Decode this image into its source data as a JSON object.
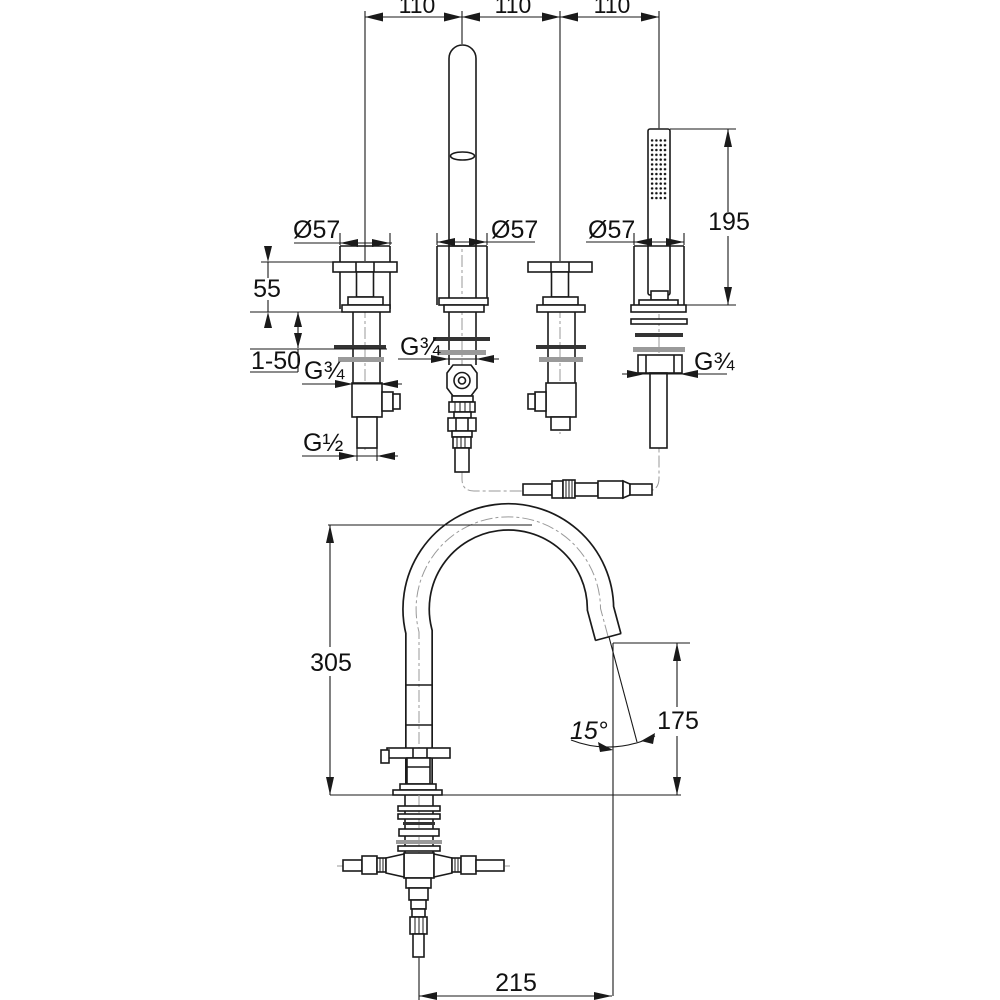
{
  "drawing": {
    "type": "technical-dimension-drawing",
    "subject": "4-hole deck-mounted bath mixer with gooseneck spout and hand shower",
    "colors": {
      "line": "#1a1a1a",
      "centerline": "#9a9a9a",
      "background": "#ffffff"
    },
    "dims": {
      "spacing_left": "110",
      "spacing_center": "110",
      "spacing_right": "110",
      "valve_diameter": "Ø57",
      "spout_diameter": "Ø57",
      "shower_diameter": "Ø57",
      "handle_height": "55",
      "deck_thickness_range": "1-50",
      "valve_thread": "G¾",
      "spout_thread": "G¾",
      "shower_thread": "G¾",
      "valve_outlet_thread": "G½",
      "shower_length": "195",
      "spout_height": "305",
      "spout_outlet_height": "175",
      "spout_angle": "15°",
      "spout_reach": "215"
    }
  }
}
